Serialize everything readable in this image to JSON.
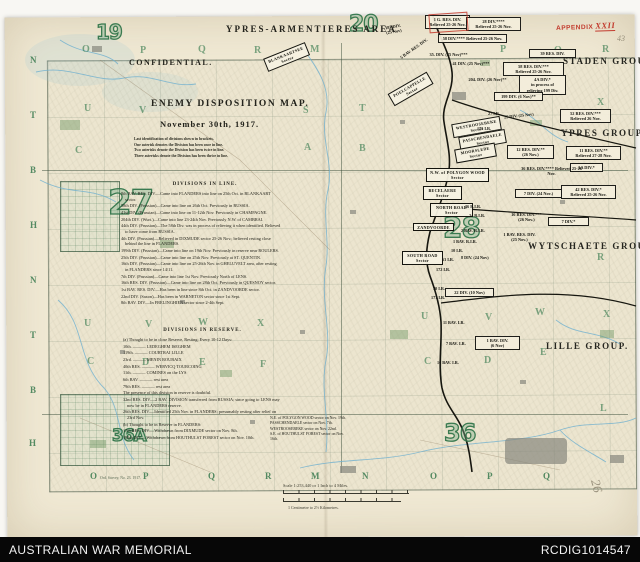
{
  "colors": {
    "paper": "#f0e9d4",
    "map_green": "#2c7246",
    "stamp_red": "#c23b2e",
    "footer_bg": "#070707",
    "water_blue": "#6fb0cf"
  },
  "footer": {
    "left": "AUSTRALIAN WAR MEMORIAL",
    "right": "RCDIG1014547"
  },
  "stamps": {
    "appendix_label": "APPENDIX",
    "appendix_number": "XXII",
    "pencil_top_right": "43",
    "pencil_bottom_right": "26"
  },
  "map": {
    "title_block": {
      "area_title": "YPRES-ARMENTIERES AREA",
      "confidential": "CONFIDENTIAL.",
      "title": "ENEMY DISPOSITION MAP.",
      "date": "November 30th, 1917.",
      "legend_lines": [
        "Last identification of divisions shewn in brackets.",
        "One asterisk denotes the Division has been once in line.",
        "Two asterisks denote the Division has been twice in line.",
        "Three asterisks denote the Division has been thrice in line."
      ]
    },
    "divisions_in_line": {
      "heading": "DIVISIONS IN LINE.",
      "entries": [
        "8th BAV. RES. DIV.—Came into FLANDERS into line on 25th Oct. in BLANKAART sector.",
        "58th DIV. (Prussian)—Came into line on 26th Oct.  Previously in RUSSIA.",
        "41st DIV. (Prussian)—Came into line on 11-12th Nov.  Previously in CHAMPAGNE.",
        "204th DIV. (Wurt.)—Came into line 23-24th Nov.  Previously N.W. of CAMBRAI.",
        "44th DIV. (Prussian)—The 58th Div. was in process of relieving it when identified.  Believed to have come from RUSSIA.",
        "4th DIV. (Prussian)—Relieved in DIXMUDE sector 25-26 Nov.; believed resting close behind the line in FLANDERS.",
        "199th DIV. (Prussian)—Came into line on 19th Nov.  Previously in reserve near ROULERS.",
        "25th DIV. (Prussian)—Came into line on 25th Nov.  Previously at ST. QUENTIN.",
        "16th DIV. (Prussian)—Came into line on 25-26th Nov. in GHELUVELT area, after resting in FLANDERS since 14/11.",
        "7th DIV. (Prussian)—Came into line 1st Nov.  Previously North of LENS.",
        "16th RES. DIV. (Prussian)—Came into line on 28th Oct.  Previously in QUESNOY sector.",
        "1st BAV. RES. DIV.—Has been in line since 8th Oct. in ZANDVOORDE sector.",
        "22nd DIV. (Saxon)—Has been in WARNETON sector since 1st Sept.",
        "8th BAV. DIV.—In FRELINGHIEN sector since 2-4th Sept."
      ]
    },
    "divisions_in_reserve": {
      "heading": "DIVISIONS IN RESERVE.",
      "entries": [
        "(a) Thought to be in close Reserve, Resting; Every 10-12 Days:",
        "10th. ——— LEDEGHEM          ISEGHEM",
        "119th. ——— COURTRAI          LILLE",
        "23rd. ——— MENIN             ROUBAIX",
        "40th RES. ——— WERVICQ       TOURCOING",
        "11th. ——— COMINES           on the LYS",
        "6th BAV. ——— rest area",
        "79th RES. ——— rest area",
        "The presence of this division in reserve is doubtful.",
        "32nd RES. DIV.—2 BAV. DIVISION transferred from RUSSIA; since going to LENS may now be in FLANDERS reserve.",
        "26th RES. DIV.—Identified 25th Nov. in FLANDERS; presumably resting after relief on 23rd Nov.",
        "(b) Thought to be in Reserve in FLANDERS:",
        "17th RES. DIV.—Withdrawn from DIXMUDE sector on Nov. 8th.",
        "195th DIV.—Withdrawn from HOUTHULST FOREST sector on Nov. 10th."
      ]
    },
    "reserve_notes": [
      "N.E. of POLYGON WOOD sector on Nov. 19th.",
      "PASSCHENDAELE sector on Nov. 7th.",
      "WESTROOSEBEKE sector on Nov. 22nd.",
      "S.E. of HOUTHULST FOREST sector on Nov. 16th."
    ],
    "groups": [
      {
        "label": "STADEN GROUP.",
        "x": 563,
        "y": 56
      },
      {
        "label": "YPRES GROUP.",
        "x": 561,
        "y": 128
      },
      {
        "label": "WYTSCHAETE GROUP.",
        "x": 528,
        "y": 241
      },
      {
        "label": "LILLE GROUP.",
        "x": 546,
        "y": 341
      }
    ],
    "sheet_numbers": [
      {
        "label": "19",
        "x": 96,
        "y": 22,
        "fs": 20
      },
      {
        "label": "20",
        "x": 349,
        "y": 14,
        "fs": 22
      },
      {
        "label": "27",
        "x": 108,
        "y": 186,
        "fs": 34
      },
      {
        "label": "28",
        "x": 443,
        "y": 214,
        "fs": 28
      },
      {
        "label": "36A",
        "x": 112,
        "y": 428,
        "fs": 17
      },
      {
        "label": "36",
        "x": 444,
        "y": 421,
        "fs": 24
      }
    ],
    "unit_boxes": [
      {
        "label": "187 DIV.\n(25 Nov)",
        "x": 384,
        "y": 23,
        "rot": -10,
        "unboxed": true
      },
      {
        "label": "1 G. RES. DIV.\nRelieved 25-26 Nov.",
        "x": 425,
        "y": 15,
        "w": 40
      },
      {
        "label": "5 BAV. RES. DIV.",
        "x": 396,
        "y": 45,
        "rot": -35,
        "unboxed": true
      },
      {
        "label": "28 DIV.****\nRelieved 25-26 Nov.",
        "x": 466,
        "y": 17,
        "w": 50
      },
      {
        "label": "58 DIV.**** Relieved 25-26 Nov.",
        "x": 438,
        "y": 34,
        "w": 64
      },
      {
        "label": "35. DIV. (25 Nov)***",
        "x": 428,
        "y": 51,
        "unboxed": true
      },
      {
        "label": "39 RES. DIV.",
        "x": 529,
        "y": 49,
        "w": 42
      },
      {
        "label": "41 DIV. (25 Nov)***",
        "x": 451,
        "y": 60,
        "unboxed": true
      },
      {
        "label": "58 RES. DIV.***\nRelieved 25-26 Nov.",
        "x": 503,
        "y": 62,
        "w": 56
      },
      {
        "label": "204. DIV. (26 Nov)**",
        "x": 467,
        "y": 76,
        "unboxed": true
      },
      {
        "label": "4A DIV.*\nin process of\nrelieving 199 Div.",
        "x": 519,
        "y": 75,
        "w": 42
      },
      {
        "label": "199 DIV. (6 Nov)**",
        "x": 494,
        "y": 92,
        "w": 44
      },
      {
        "label": "52 RES. DIV.***\nRelieved 26 Nov.",
        "x": 560,
        "y": 109,
        "w": 46
      },
      {
        "label": "12 RES. DIV.**\n(26 Nov.)",
        "x": 507,
        "y": 145,
        "w": 42
      },
      {
        "label": "11 RES. DIV.**\nRelieved 27-28 Nov.",
        "x": 566,
        "y": 146,
        "w": 50
      },
      {
        "label": "3A DIV.*",
        "x": 570,
        "y": 163,
        "w": 28
      },
      {
        "label": "36 RES. DIV.****  Relieved 25-26 Nov.",
        "x": 516,
        "y": 165,
        "w": 68,
        "unboxed": true
      },
      {
        "label": "42 RES. DIV.*\nRelieved 25-26 Nov.",
        "x": 561,
        "y": 185,
        "w": 50
      },
      {
        "label": "7 DIV. (24 Nov.)",
        "x": 515,
        "y": 189,
        "w": 42
      },
      {
        "label": "7 DIV.*",
        "x": 548,
        "y": 217,
        "w": 36
      },
      {
        "label": "16 RES. DIV.***\n(26 Nov.)",
        "x": 502,
        "y": 211,
        "w": 46,
        "unboxed": true
      },
      {
        "label": "1 BAV. RES. DIV.\n(25 Nov.)",
        "x": 494,
        "y": 231,
        "w": 48,
        "unboxed": true
      },
      {
        "label": "22 DIV. (10 Nov)",
        "x": 445,
        "y": 288,
        "w": 44
      },
      {
        "label": "1 BAV. DIV.\n(6 Nov)",
        "x": 475,
        "y": 336,
        "w": 40
      }
    ],
    "sector_boxes": [
      {
        "label": "BLANKAARTSEE\nSector",
        "x": 264,
        "y": 50,
        "rot": -22,
        "w": 40
      },
      {
        "label": "POELCAPPELLE\nSector",
        "x": 388,
        "y": 82,
        "rot": -30,
        "w": 40
      },
      {
        "label": "WESTROOSEBEKE\nSector",
        "x": 452,
        "y": 120,
        "rot": -10,
        "w": 44
      },
      {
        "label": "PASSCHENDAELE\nSector",
        "x": 459,
        "y": 133,
        "rot": -10,
        "w": 42
      },
      {
        "label": "MOORSLEDE\nSector",
        "x": 455,
        "y": 146,
        "rot": -10,
        "w": 36
      },
      {
        "label": "N.W. of POLYGON WOOD\nSector",
        "x": 426,
        "y": 168,
        "w": 58
      },
      {
        "label": "BECELAERE\nSector",
        "x": 423,
        "y": 186,
        "w": 34
      },
      {
        "label": "NORTH ROAD\nSector",
        "x": 430,
        "y": 203,
        "w": 38
      },
      {
        "label": "ZANDVOORDE",
        "x": 413,
        "y": 223,
        "w": 36
      },
      {
        "label": "SOUTH ROAD\nSector",
        "x": 402,
        "y": 251,
        "w": 36
      }
    ],
    "unit_texts": [
      {
        "label": "27 I.R.",
        "x": 488,
        "y": 111
      },
      {
        "label": "25 DIV. (25 Nov)",
        "x": 504,
        "y": 113,
        "rot": -6
      },
      {
        "label": "175 I.R.",
        "x": 477,
        "y": 126
      },
      {
        "label": "26 R.I.R.",
        "x": 465,
        "y": 204
      },
      {
        "label": "24 R.I.R.",
        "x": 469,
        "y": 213
      },
      {
        "label": "2 BAV. R.I.R.",
        "x": 461,
        "y": 228
      },
      {
        "label": "1 BAV. R.I.R.",
        "x": 453,
        "y": 239
      },
      {
        "label": "10 I.R.",
        "x": 451,
        "y": 248
      },
      {
        "label": "8 DIV. (24 Nov)",
        "x": 461,
        "y": 255
      },
      {
        "label": "63 I.R.",
        "x": 442,
        "y": 257
      },
      {
        "label": "172 I.R.",
        "x": 436,
        "y": 267
      },
      {
        "label": "70 I.R.",
        "x": 433,
        "y": 286
      },
      {
        "label": "177 I.R.",
        "x": 431,
        "y": 295
      },
      {
        "label": "11 BAV. I.R.",
        "x": 443,
        "y": 320
      },
      {
        "label": "7 BAV. I.R.",
        "x": 446,
        "y": 341
      },
      {
        "label": "16 BAV. I.R.",
        "x": 437,
        "y": 360
      }
    ],
    "grid_letters": [
      {
        "label": "O",
        "x": 82,
        "y": 44
      },
      {
        "label": "P",
        "x": 140,
        "y": 45
      },
      {
        "label": "Q",
        "x": 198,
        "y": 44
      },
      {
        "label": "R",
        "x": 254,
        "y": 45
      },
      {
        "label": "M",
        "x": 310,
        "y": 44
      },
      {
        "label": "P",
        "x": 500,
        "y": 44
      },
      {
        "label": "Q",
        "x": 554,
        "y": 45
      },
      {
        "label": "R",
        "x": 602,
        "y": 44
      },
      {
        "label": "U",
        "x": 84,
        "y": 103
      },
      {
        "label": "V",
        "x": 139,
        "y": 105
      },
      {
        "label": "S",
        "x": 303,
        "y": 105
      },
      {
        "label": "T",
        "x": 359,
        "y": 103
      },
      {
        "label": "X",
        "x": 597,
        "y": 97
      },
      {
        "label": "C",
        "x": 75,
        "y": 145
      },
      {
        "label": "A",
        "x": 304,
        "y": 142
      },
      {
        "label": "B",
        "x": 359,
        "y": 143
      },
      {
        "label": "U",
        "x": 84,
        "y": 318
      },
      {
        "label": "V",
        "x": 145,
        "y": 319
      },
      {
        "label": "W",
        "x": 198,
        "y": 317
      },
      {
        "label": "X",
        "x": 257,
        "y": 318
      },
      {
        "label": "U",
        "x": 421,
        "y": 311
      },
      {
        "label": "V",
        "x": 485,
        "y": 312
      },
      {
        "label": "W",
        "x": 535,
        "y": 307
      },
      {
        "label": "X",
        "x": 603,
        "y": 309
      },
      {
        "label": "C",
        "x": 87,
        "y": 356
      },
      {
        "label": "D",
        "x": 142,
        "y": 357
      },
      {
        "label": "E",
        "x": 199,
        "y": 357
      },
      {
        "label": "F",
        "x": 260,
        "y": 359
      },
      {
        "label": "C",
        "x": 424,
        "y": 356
      },
      {
        "label": "D",
        "x": 484,
        "y": 355
      },
      {
        "label": "E",
        "x": 540,
        "y": 347
      },
      {
        "label": "R",
        "x": 597,
        "y": 252
      },
      {
        "label": "L",
        "x": 600,
        "y": 403
      }
    ],
    "edge_letters_left": [
      {
        "label": "N",
        "x": 30,
        "y": 55
      },
      {
        "label": "T",
        "x": 30,
        "y": 110
      },
      {
        "label": "B",
        "x": 30,
        "y": 165
      },
      {
        "label": "H",
        "x": 30,
        "y": 220
      },
      {
        "label": "N",
        "x": 30,
        "y": 275
      },
      {
        "label": "T",
        "x": 30,
        "y": 330
      },
      {
        "label": "B",
        "x": 30,
        "y": 385
      },
      {
        "label": "H",
        "x": 29,
        "y": 438
      }
    ],
    "edge_letters_bottom": [
      {
        "label": "O",
        "x": 90,
        "y": 471
      },
      {
        "label": "P",
        "x": 143,
        "y": 471
      },
      {
        "label": "Q",
        "x": 208,
        "y": 471
      },
      {
        "label": "R",
        "x": 265,
        "y": 471
      },
      {
        "label": "M",
        "x": 311,
        "y": 471
      },
      {
        "label": "N",
        "x": 362,
        "y": 471
      },
      {
        "label": "O",
        "x": 430,
        "y": 471
      },
      {
        "label": "P",
        "x": 487,
        "y": 471
      },
      {
        "label": "Q",
        "x": 543,
        "y": 471
      }
    ],
    "scale": {
      "survey_note": "Ord. Survey, No. 23. 1917.",
      "title": "Scale 1:253,440 or 1 Inch to 4 Miles.",
      "metric": "1 Centimetre to 2½ Kilometres."
    }
  }
}
